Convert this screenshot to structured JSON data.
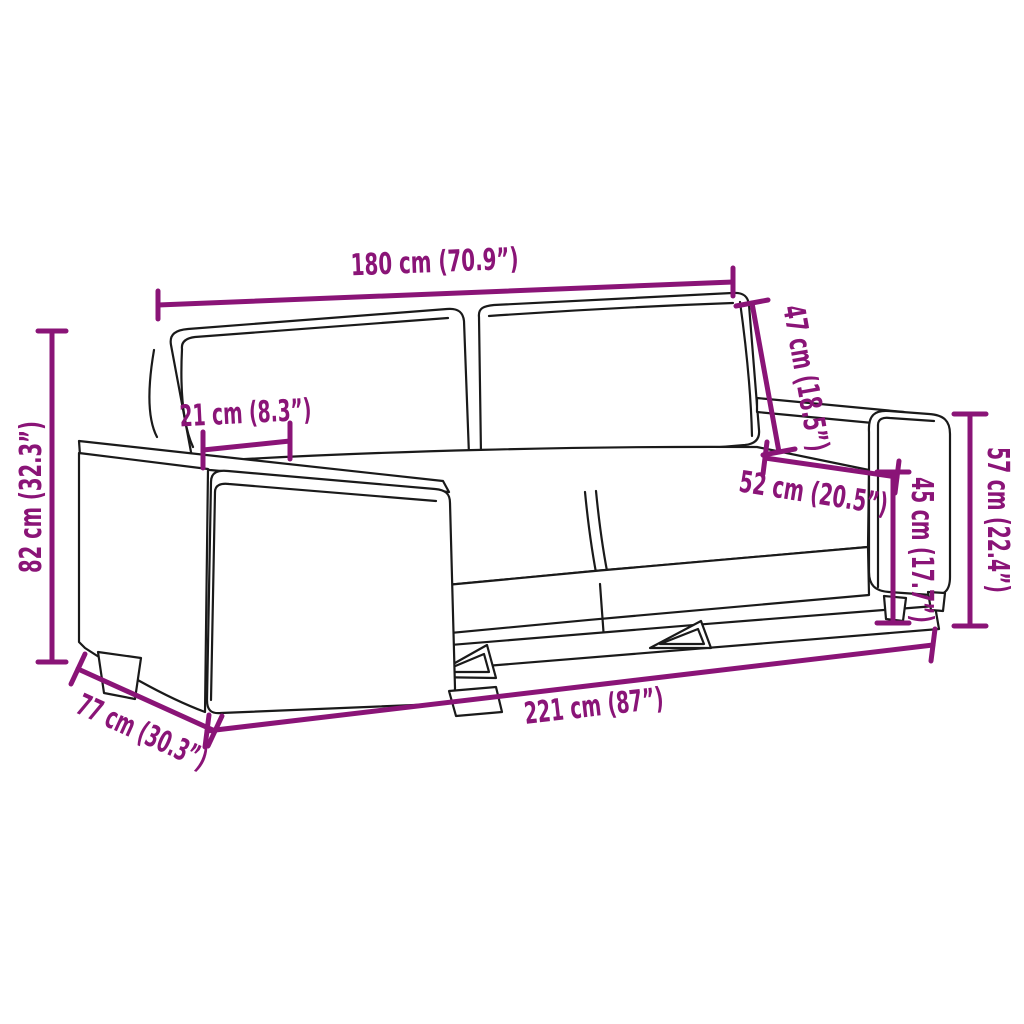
{
  "diagram": {
    "title": "Sofa dimensions diagram",
    "accent_color": "#8A1477",
    "line_color": "#1A1A1A",
    "background_color": "#FFFFFF",
    "dimensions": [
      {
        "name": "overall-width-top",
        "label": "180 cm (70.9”)"
      },
      {
        "name": "total-height",
        "label": "82 cm (32.3”)"
      },
      {
        "name": "armrest-width",
        "label": "21 cm (8.3”)"
      },
      {
        "name": "backrest-height",
        "label": "47 cm (18.5”)"
      },
      {
        "name": "seat-depth",
        "label": "52 cm (20.5”)"
      },
      {
        "name": "seat-height",
        "label": "45 cm (17.7”)"
      },
      {
        "name": "armrest-height",
        "label": "57 cm (22.4”)"
      },
      {
        "name": "total-depth",
        "label": "77 cm (30.3”)"
      },
      {
        "name": "total-width",
        "label": "221 cm (87”)"
      }
    ]
  }
}
